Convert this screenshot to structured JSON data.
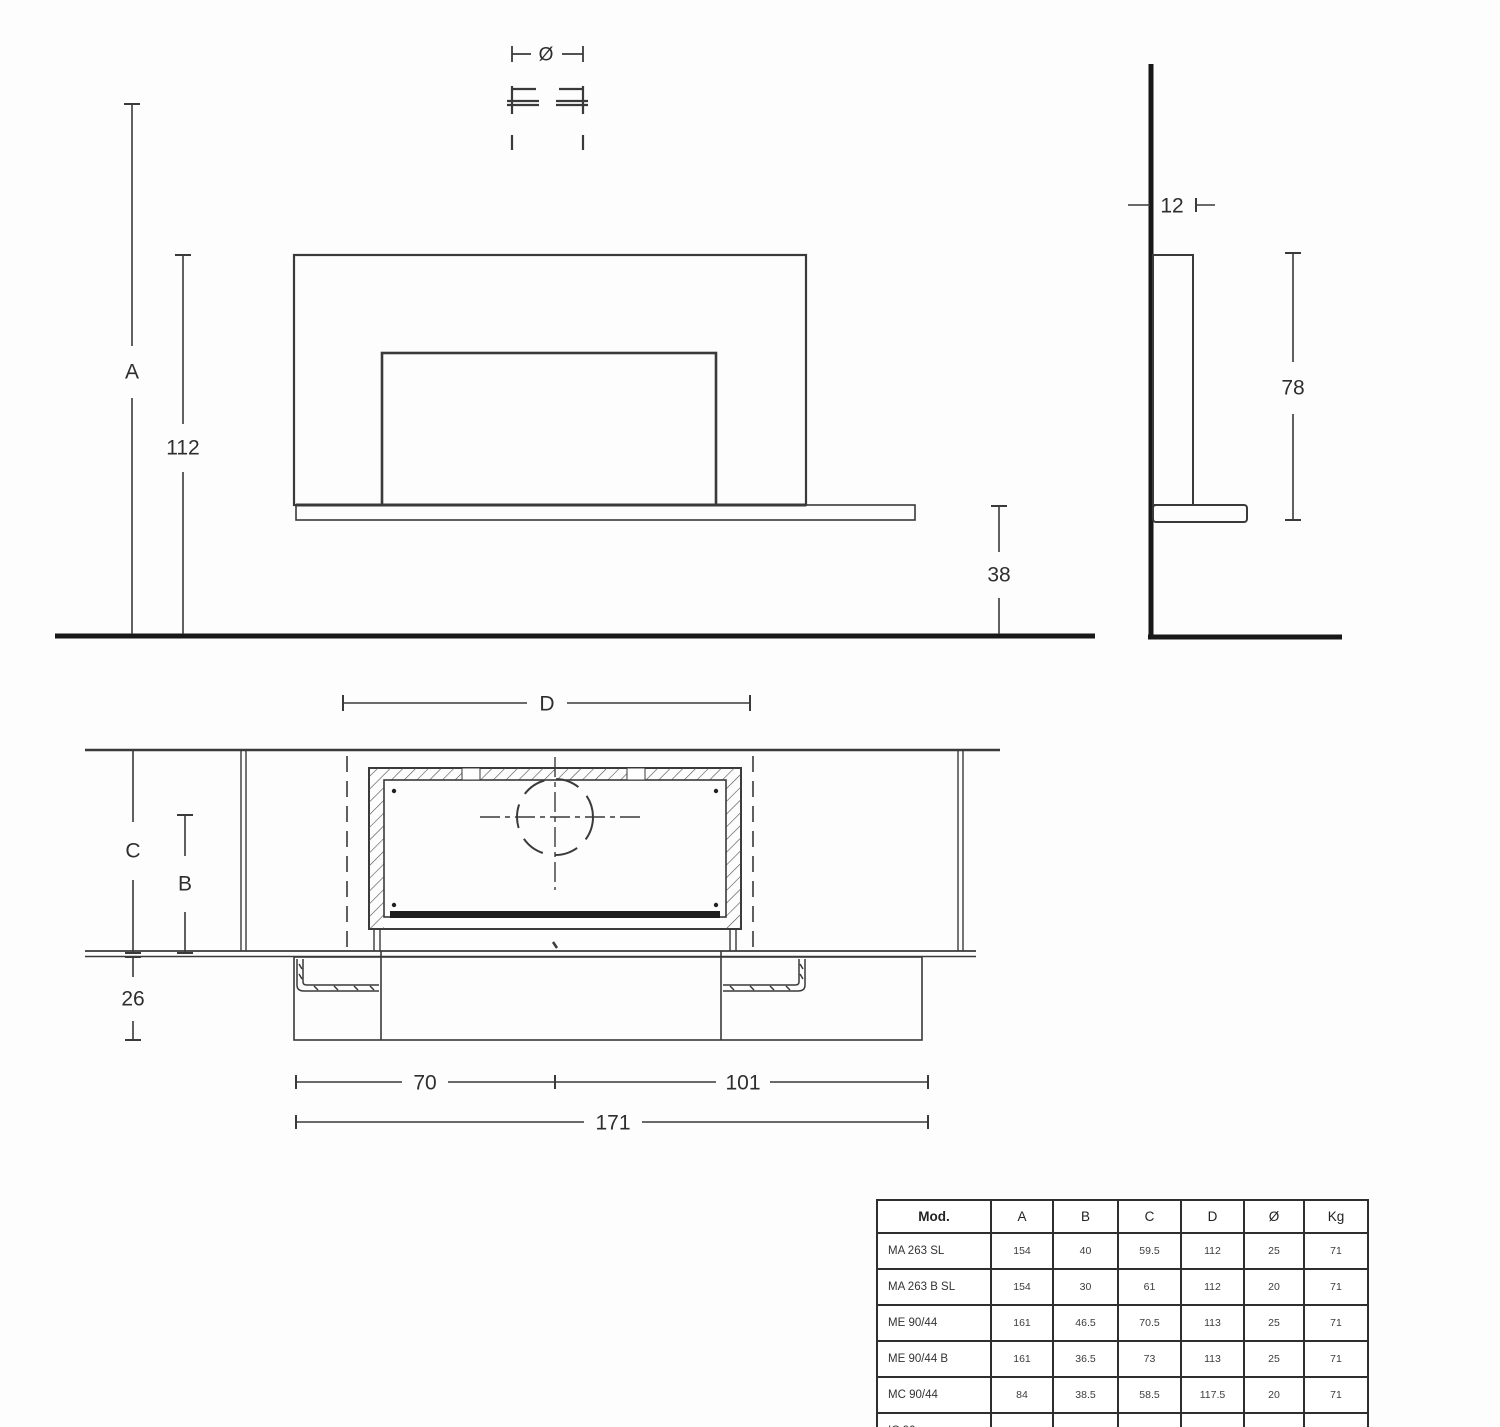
{
  "drawing": {
    "labels": {
      "a": "A",
      "height_112": "112",
      "diameter": "Ø",
      "offset_38": "38",
      "depth_12": "12",
      "height_78": "78",
      "d": "D",
      "c": "C",
      "b": "B",
      "depth_26": "26",
      "width_70": "70",
      "width_101": "101",
      "width_171": "171"
    },
    "colors": {
      "thin_line": "#3a3a3a",
      "thick_line": "#181818"
    }
  },
  "table": {
    "headers": [
      "Mod.",
      "A",
      "B",
      "C",
      "D",
      "Ø",
      "Kg"
    ],
    "rows": [
      [
        "MA 263 SL",
        "154",
        "40",
        "59.5",
        "112",
        "25",
        "71"
      ],
      [
        "MA 263 B SL",
        "154",
        "30",
        "61",
        "112",
        "20",
        "71"
      ],
      [
        "ME 90/44",
        "161",
        "46.5",
        "70.5",
        "113",
        "25",
        "71"
      ],
      [
        "ME 90/44 B",
        "161",
        "36.5",
        "73",
        "113",
        "25",
        "71"
      ],
      [
        "MC 90/44",
        "84",
        "38.5",
        "58.5",
        "117.5",
        "20",
        "71"
      ],
      [
        "IC 90",
        "91.5",
        "32.5",
        "50",
        "102",
        "15",
        "71"
      ]
    ]
  }
}
